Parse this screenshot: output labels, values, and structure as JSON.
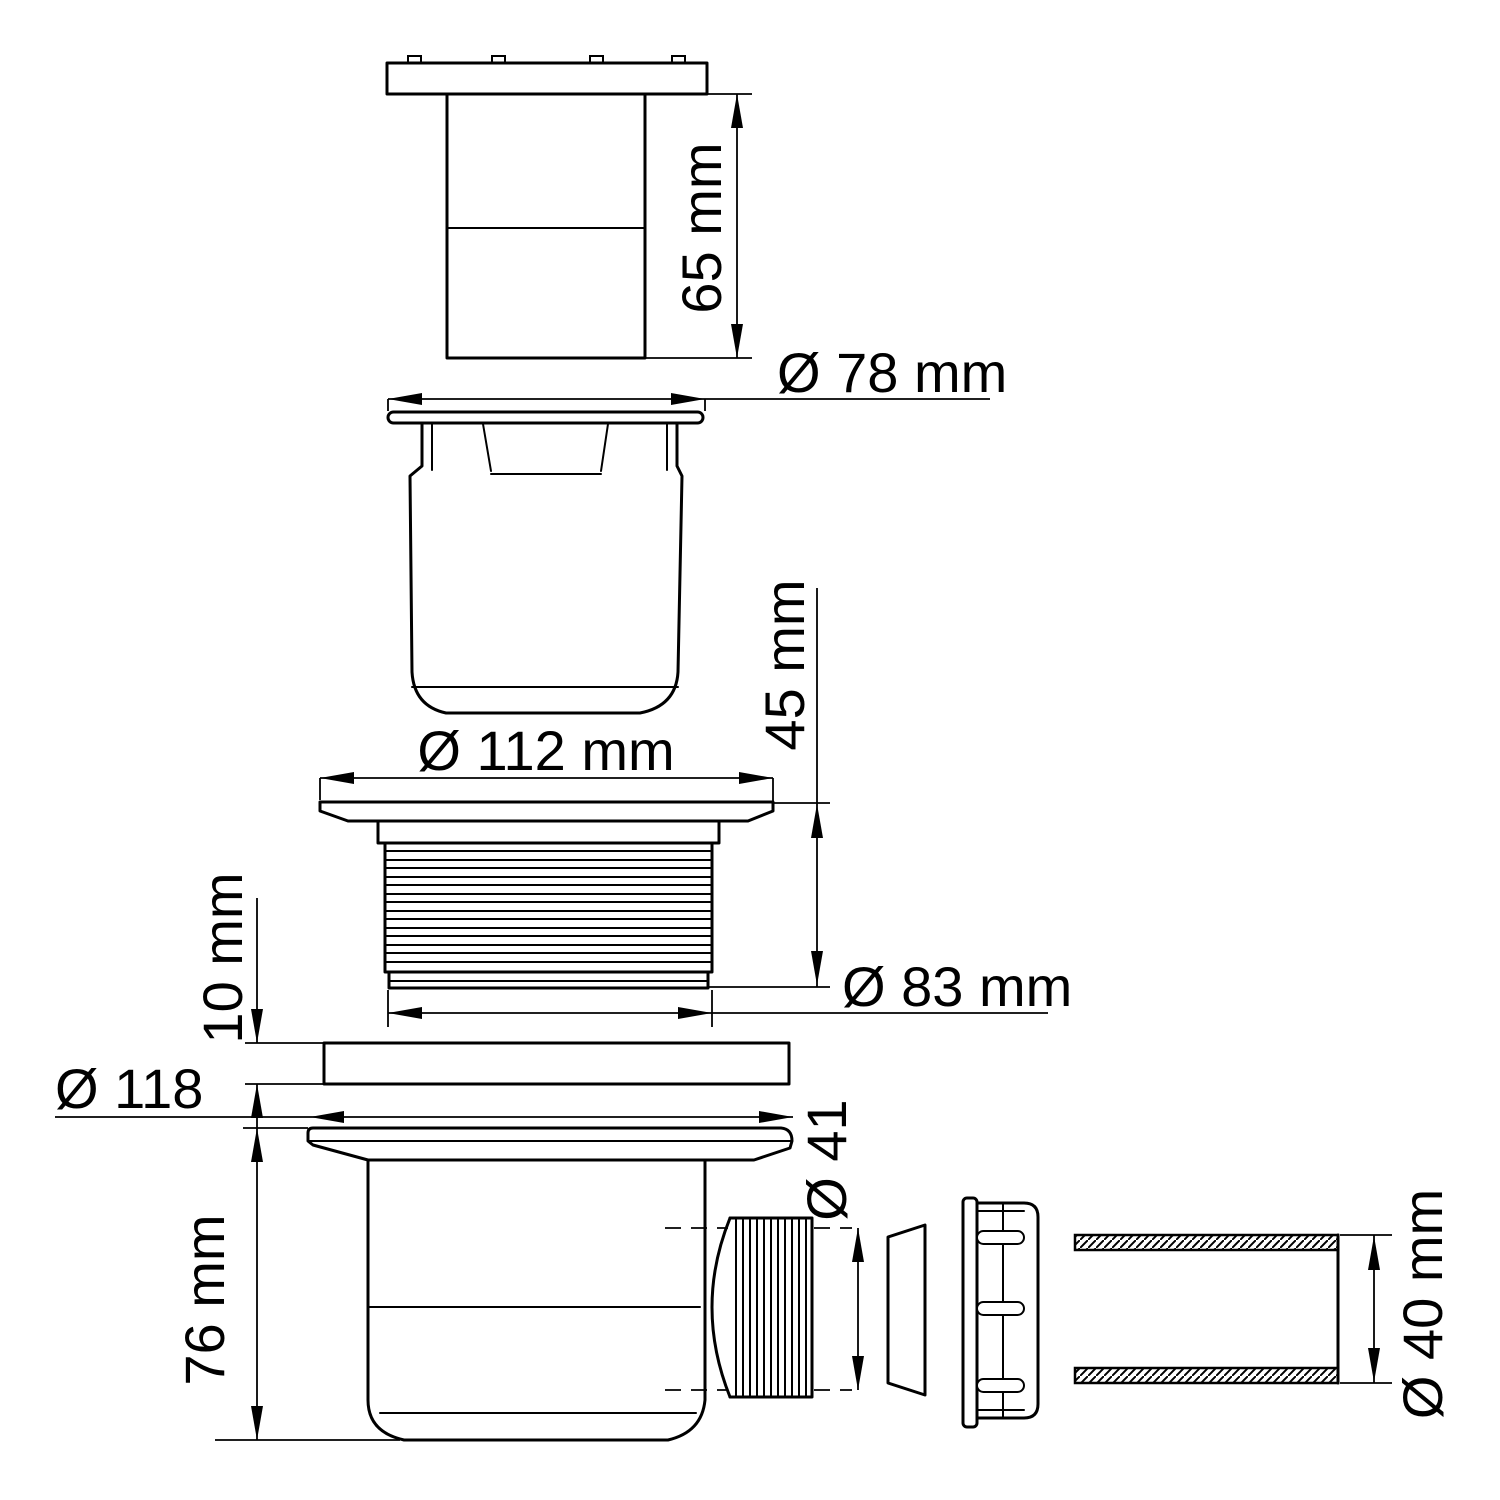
{
  "drawing": {
    "type": "technical-exploded-diagram",
    "subject": "shower drain trap assembly",
    "ink_color": "#000000",
    "background_color": "#ffffff",
    "dimensions": {
      "cap_height": "65 mm",
      "cap_flange_diameter": "Ø 78 mm",
      "cup_flange_diameter": "Ø 112 mm",
      "cup_height": "45 mm",
      "ring_thread_diameter": "Ø 83 mm",
      "seal_thickness": "10 mm",
      "body_flange_diameter": "Ø 118",
      "body_height": "76 mm",
      "outlet_thread_diameter": "Ø 41",
      "pipe_diameter": "Ø 40 mm"
    }
  }
}
